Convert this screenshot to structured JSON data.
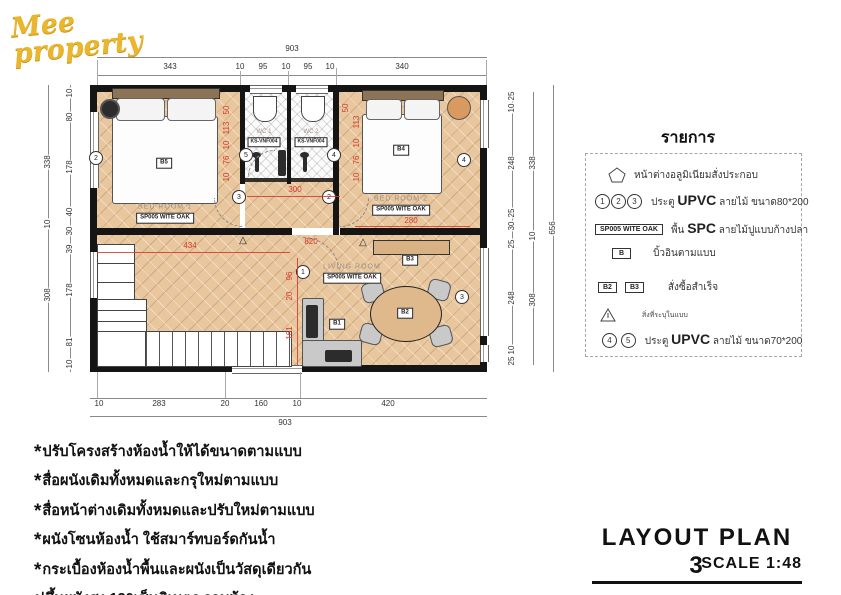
{
  "logo_text": "Mee property",
  "title_block": {
    "title": "LAYOUT PLAN 3",
    "scale": "SCALE 1:48"
  },
  "legend": {
    "title": "รายการ",
    "items": [
      {
        "label": "หน้าต่างอลูมิเนียมสั่งประกอบ"
      },
      {
        "nums": [
          "1",
          "2",
          "3"
        ],
        "label_pre": "ประตู",
        "label_big": "UPVC",
        "label_post": "ลายไม้ ขนาด80*200"
      },
      {
        "box": "SP005 WITE OAK",
        "label_pre": "พื้น",
        "label_big": "SPC",
        "label_post": "ลายไม้ปูแบบก้างปลา"
      },
      {
        "box": "B",
        "label": "บิ้วอินตามแบบ"
      },
      {
        "boxes": [
          "B2",
          "B3"
        ],
        "label": "สั่งซื้อสำเร็จ"
      },
      {
        "label": "สิ่งที่ระบุในแบบ"
      },
      {
        "nums": [
          "4",
          "5"
        ],
        "label_pre": "ประตู",
        "label_big": "UPVC",
        "label_post": "ลายไม้ ขนาด70*200"
      }
    ]
  },
  "notes": [
    {
      "star": "*",
      "text": "ปรับโครงสร้างห้องน้ำให้ได้ขนาดตามแบบ"
    },
    {
      "star": "*",
      "text": "สื่อผนังเดิมทั้งหมดและกรุใหม่ตามแบบ"
    },
    {
      "star": "*",
      "text": "สื่อหน้าต่างเดิมทั้งหมดและปรับใหม่ตามแบบ"
    },
    {
      "star": "*",
      "text": "ผนังโซนห้องน้ำ ใช้สมาร์ทบอร์ดกันน้ำ"
    },
    {
      "star": "*",
      "text": "กระเบื้องห้องน้ำพื้นและผนังเป็นวัสดุเดียวกัน"
    },
    {
      "star": "",
      "text": "ปูขึ้นผนังสูง 120เซ็นติเมตร รอบห้อง"
    }
  ],
  "plan": {
    "rooms": {
      "bedroom1": {
        "name": "BED ROOM 1",
        "floor": "SP005 WITE OAK"
      },
      "bedroom2": {
        "name": "BED ROOM 2",
        "floor": "SP005 WITE OAK"
      },
      "living": {
        "name": "LIVING ROOM",
        "floor": "SP005 WITE OAK"
      },
      "wc1": {
        "name": "WC 1",
        "tile": "KS-VNF004"
      },
      "wc2": {
        "name": "WC 2",
        "tile": "KS-VNF004"
      }
    },
    "furniture_labels": {
      "b1": "B1",
      "b2": "B2",
      "b3": "B3",
      "b4": "B4",
      "b5": "B5"
    },
    "door_markers": [
      "2",
      "5",
      "4",
      "3",
      "2",
      "4",
      "1",
      "3"
    ],
    "dims": {
      "top_total": "903",
      "top_segments": [
        "343",
        "10",
        "95",
        "10",
        "95",
        "10",
        "340"
      ],
      "bottom_segments": [
        "10",
        "283",
        "20",
        "160",
        "10",
        "420"
      ],
      "bottom_total": "903",
      "left_outer": [
        "338",
        "10",
        "308"
      ],
      "left_inner": [
        "10",
        "80",
        "178",
        "40",
        "30",
        "39",
        "178",
        "81",
        "10"
      ],
      "right_inner": [
        "25",
        "10",
        "248",
        "25",
        "30",
        "25",
        "248",
        "10",
        "25"
      ],
      "right_mid": [
        "338",
        "10",
        "308"
      ],
      "right_total": "656",
      "red": {
        "wc_left": [
          "50",
          "113",
          "10",
          "76",
          "10"
        ],
        "wc_right": [
          "50",
          "113",
          "10",
          "76",
          "10"
        ],
        "hall": "300",
        "bedroom2_width": "280",
        "living_h": "434",
        "living_total": "820",
        "living_v": [
          "96",
          "20",
          "161"
        ]
      }
    }
  },
  "colors": {
    "wall": "#151515",
    "wood_floor": "#e8c69e",
    "red_dim": "#d43a2a",
    "logo_gold": "#e9b62e"
  }
}
